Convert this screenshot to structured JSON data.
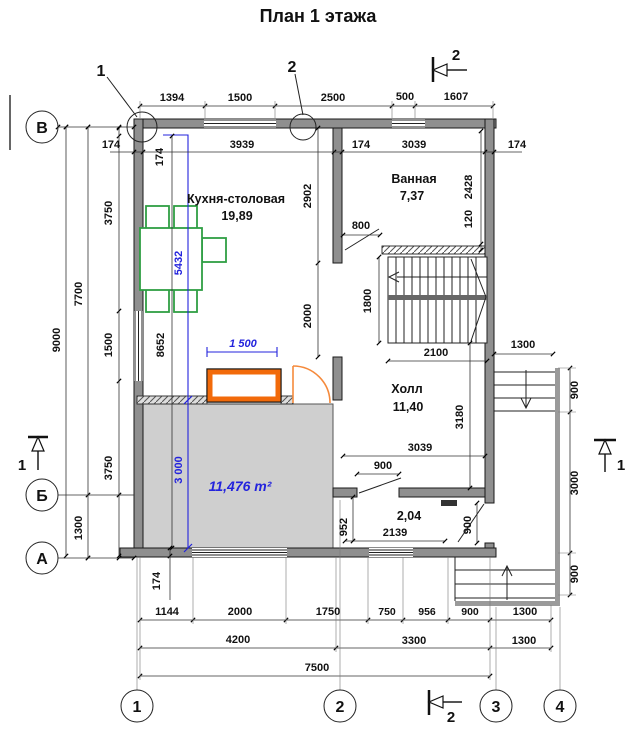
{
  "title": "План 1 этажа",
  "axes": {
    "row_top": "В",
    "row_mid": "Б",
    "row_bottom": "А",
    "col_1": "1",
    "col_2": "2",
    "col_3": "3",
    "col_4": "4"
  },
  "leaders": {
    "axis1": "1",
    "axis2": "2"
  },
  "sections": {
    "top": "2",
    "bottom": "2",
    "left": "1",
    "right": "1"
  },
  "rooms": {
    "kitchen": {
      "name": "Кухня-столовая",
      "area": "19,89"
    },
    "bath": {
      "name": "Ванная",
      "area": "7,37"
    },
    "hall": {
      "name": "Холл",
      "area": "11,40"
    },
    "vestibule": {
      "area": "2,04"
    }
  },
  "blue_annotations": {
    "total_height": "5432",
    "terrace_height": "3 000",
    "hearth_width": "1 500",
    "terrace_area": "11,476 m²"
  },
  "colors": {
    "annotation_blue": "#2323dd",
    "furniture_green": "#2f9e44",
    "accent_orange": "#f26a0a",
    "terrace_gray": "#cfcfcf"
  },
  "dims": {
    "d174": "174",
    "top_chain": [
      "1394",
      "1500",
      "2500",
      "500",
      "1607"
    ],
    "kitchen_width": "3939",
    "bath_width": "3039",
    "left_total": "9000",
    "left_sub": "7700",
    "left_b_a": "1300",
    "left_chain": [
      "3750",
      "1500",
      "3750"
    ],
    "kitchen_height": "8652",
    "kitchen_right": [
      "2902",
      "2000"
    ],
    "bath_height": "2428",
    "bath_wall": "120",
    "bath_door": "800",
    "stair_height": "1800",
    "stair_width": "2100",
    "porch_top": "1300",
    "hall_height": "3180",
    "hall_width": "3039",
    "hall_door": "900",
    "vest_width": "2139",
    "vest_left": "952",
    "entry_door": "900",
    "right_chain": [
      "900",
      "3000",
      "900"
    ],
    "bottom_chain": [
      "1144",
      "2000",
      "1750",
      "750",
      "956",
      "900",
      "1300"
    ],
    "bottom_sub": [
      "4200",
      "3300",
      "1300"
    ],
    "bottom_total": "7500"
  }
}
